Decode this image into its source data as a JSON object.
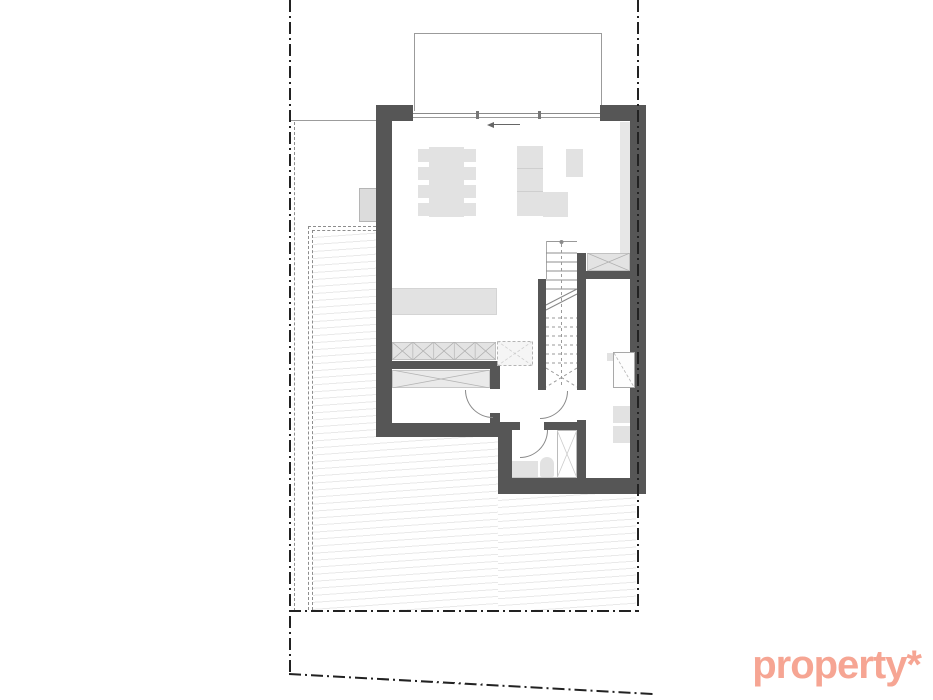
{
  "watermark": {
    "text": "property*",
    "color": "#f6a593"
  },
  "palette": {
    "background": "#ffffff",
    "wall": "#565656",
    "furniture": "#e2e2e2",
    "furniture_border": "#c9c9c9",
    "hatch_line": "#e9e9e9",
    "boundary": "#222222",
    "thin_line": "#9c9c9c"
  },
  "plan": {
    "type": "floor-plan",
    "visible_elements": [
      "site-boundary-dash-dot",
      "terrace-hatched",
      "canopy-outline",
      "living-dining-room",
      "kitchen-island",
      "dining-table-with-8-chairs",
      "l-shaped-sofa",
      "armchair",
      "built-in-wardrobe-row",
      "staircase",
      "hallway",
      "utility-room",
      "bathroom-with-toilet-and-shower",
      "office-room-with-desk"
    ]
  }
}
